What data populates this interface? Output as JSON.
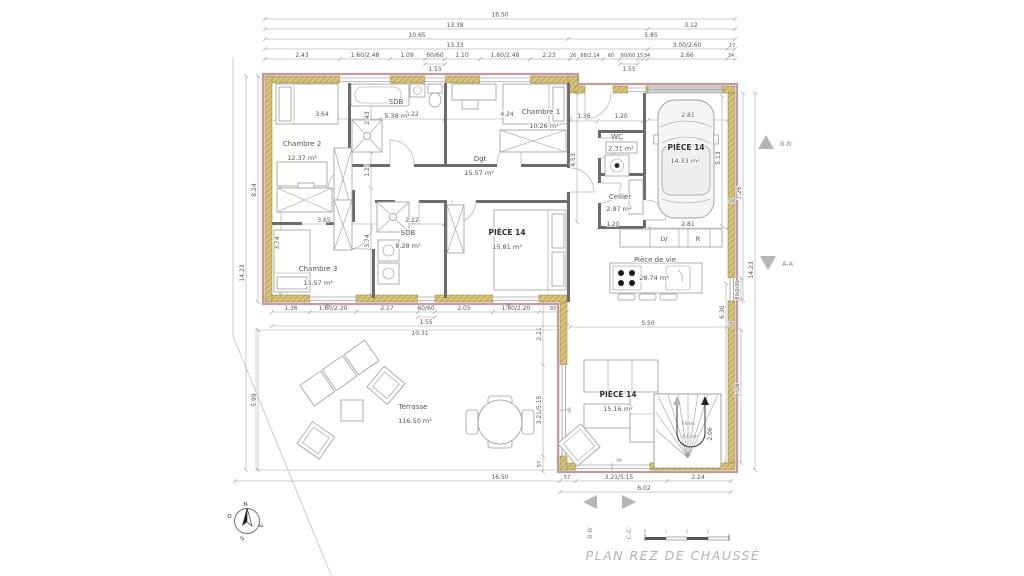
{
  "title": "PLAN REZ DE CHAUSSÉ",
  "rooms": {
    "chambre2": {
      "name": "Chambre 2",
      "area": "12.37 m²"
    },
    "sdb1": {
      "name": "SDB",
      "area": "5.38 m²"
    },
    "chambre1": {
      "name": "Chambre 1",
      "area": "10.26 m²"
    },
    "dgt": {
      "name": "Dgt",
      "area": "15.57 m²"
    },
    "chambre3": {
      "name": "Chambre 3",
      "area": "13.57 m²"
    },
    "sdb2": {
      "name": "SDB",
      "area": "8.28 m²"
    },
    "piece14_chambre": {
      "name": "PIÈCE 14",
      "area": "15.81 m²"
    },
    "wc": {
      "name": "WC",
      "area": "2.31 m²"
    },
    "cellier": {
      "name": "Cellier",
      "area": "2.97 m²"
    },
    "piece14_garage": {
      "name": "PIÈCE 14",
      "area": "14.33 m²"
    },
    "piece_de_vie": {
      "name": "Pièce de vie",
      "area": "28.74 m²"
    },
    "piece14_sejour": {
      "name": "PIÈCE 14",
      "area": "15.16 m²"
    },
    "terrasse": {
      "name": "Terrasse",
      "area": "116.50 m²"
    },
    "tremie": {
      "name": "Trémie",
      "area": "4.43 m²"
    }
  },
  "appliances": {
    "dishwasher": "LV",
    "fridge": "R"
  },
  "window_tags": [
    "VR",
    "VR",
    "VR",
    "VR"
  ],
  "dims": {
    "top": [
      "16.50",
      "13.38",
      "3.12",
      "10.65",
      "5.85",
      "13.33",
      "3.00/2.60",
      "17"
    ],
    "toprow": [
      "2.43",
      "1.60/2.48",
      "1.09",
      "60/60",
      "1.10",
      "1.60/2.48",
      "2.23",
      "26",
      "88/2.14",
      "60",
      "60/60",
      "15",
      "34",
      "2.66",
      "34"
    ],
    "sub155": [
      "1.55",
      "1.55",
      "1.55"
    ],
    "left": [
      "14.23",
      "8.24",
      "5.99"
    ],
    "inner": [
      "3.64",
      "2.22",
      "4.24",
      "2.43",
      "1.25",
      "3.74",
      "3.74",
      "3.65",
      "2.22",
      "1.36",
      "1.20",
      "4.53",
      "2.81",
      "5.13",
      "1.20",
      "2.81",
      "5.50"
    ],
    "bottomrow": [
      "1.36",
      "1.60/2.20",
      "2.17",
      "60/60",
      "2.05",
      "1.60/2.20",
      "93",
      "10.31"
    ],
    "right": [
      "7.26",
      "34",
      "80/2.31",
      "14.23",
      "6.30",
      "35",
      "6.18",
      "2.06"
    ],
    "westglass": [
      "2.21",
      "3.21/5.15",
      "57"
    ],
    "bottom": [
      "16.50",
      "57",
      "3.21/5.15",
      "2.24",
      "6.02"
    ]
  },
  "markers": {
    "bb_right": "B-B'",
    "aa_right": "A-A'",
    "bb_bottom": "B-B'",
    "cc_bottom": "C-C'"
  },
  "compass": {
    "n": "N",
    "e": "E",
    "s": "S",
    "o": "O"
  },
  "scale_ticks": [
    "0",
    "1",
    "2",
    "3"
  ]
}
